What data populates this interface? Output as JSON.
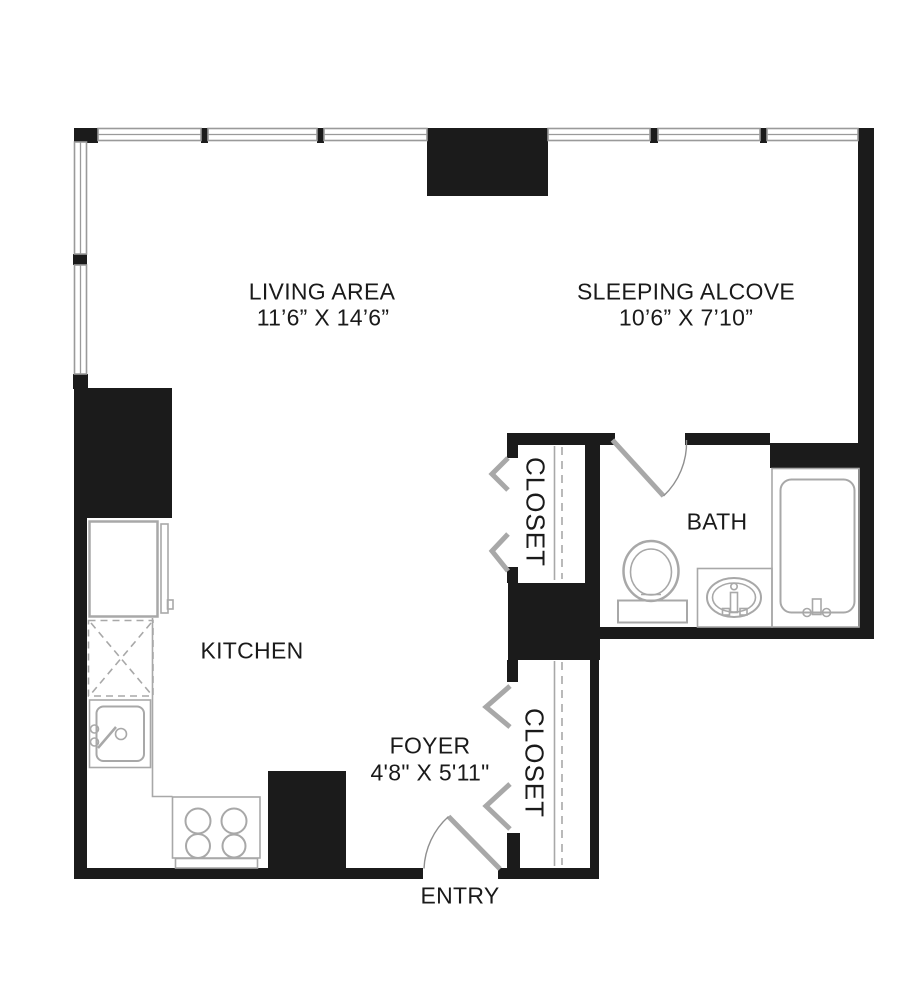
{
  "colors": {
    "wall": "#1b1b1b",
    "fixture": "#a8a8a8",
    "window-line": "#9a9a9a",
    "text": "#1a1a1a"
  },
  "rooms": {
    "living": {
      "label": "LIVING AREA",
      "dims": "11’6” X 14’6”"
    },
    "sleeping": {
      "label": "SLEEPING ALCOVE",
      "dims": "10’6” X 7’10”"
    },
    "kitchen": {
      "label": "KITCHEN"
    },
    "bath": {
      "label": "BATH"
    },
    "foyer": {
      "label": "FOYER",
      "dims": "4'8\" X 5'11\""
    },
    "entry": {
      "label": "ENTRY"
    },
    "closet_upper": {
      "label": "CLOSET"
    },
    "closet_lower": {
      "label": "CLOSET"
    }
  },
  "fixtures": [
    "refrigerator",
    "dashed-cabinet",
    "kitchen-sink",
    "range",
    "toilet",
    "vanity-sink",
    "bathtub",
    "entry-door",
    "bath-door",
    "closet-bifold-doors",
    "windows"
  ]
}
